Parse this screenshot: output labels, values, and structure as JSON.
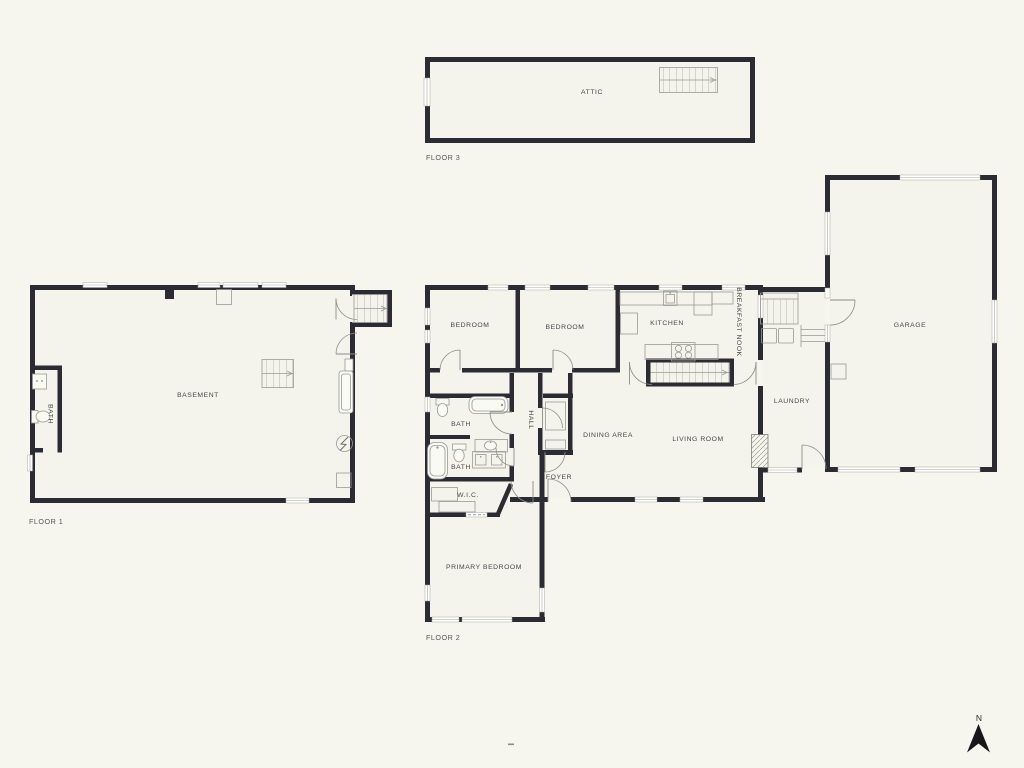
{
  "document": {
    "type": "multi-floor-house-plan"
  },
  "compass": {
    "label": "N"
  },
  "footer_mark": "-",
  "floors": [
    {
      "label": "FLOOR 3",
      "rooms": [
        {
          "label": "ATTIC"
        }
      ]
    },
    {
      "label": "FLOOR 1",
      "rooms": [
        {
          "label": "BASEMENT"
        },
        {
          "label": "BATH"
        }
      ]
    },
    {
      "label": "FLOOR 2",
      "rooms": [
        {
          "label": "BEDROOM"
        },
        {
          "label": "BEDROOM"
        },
        {
          "label": "KITCHEN"
        },
        {
          "label": "BREAKFAST NOOK"
        },
        {
          "label": "LAUNDRY"
        },
        {
          "label": "GARAGE"
        },
        {
          "label": "DINING AREA"
        },
        {
          "label": "LIVING ROOM"
        },
        {
          "label": "FOYER"
        },
        {
          "label": "HALL"
        },
        {
          "label": "BATH"
        },
        {
          "label": "BATH"
        },
        {
          "label": "W.I.C."
        },
        {
          "label": "PRIMARY BEDROOM"
        }
      ]
    }
  ],
  "colors": {
    "background": "#f6f6ef",
    "interior": "#f4f4ec",
    "wall": "#2b2b33",
    "thin_line": "#9a9a96",
    "label_text": "#46464c",
    "north_arrow": "#17171b"
  }
}
